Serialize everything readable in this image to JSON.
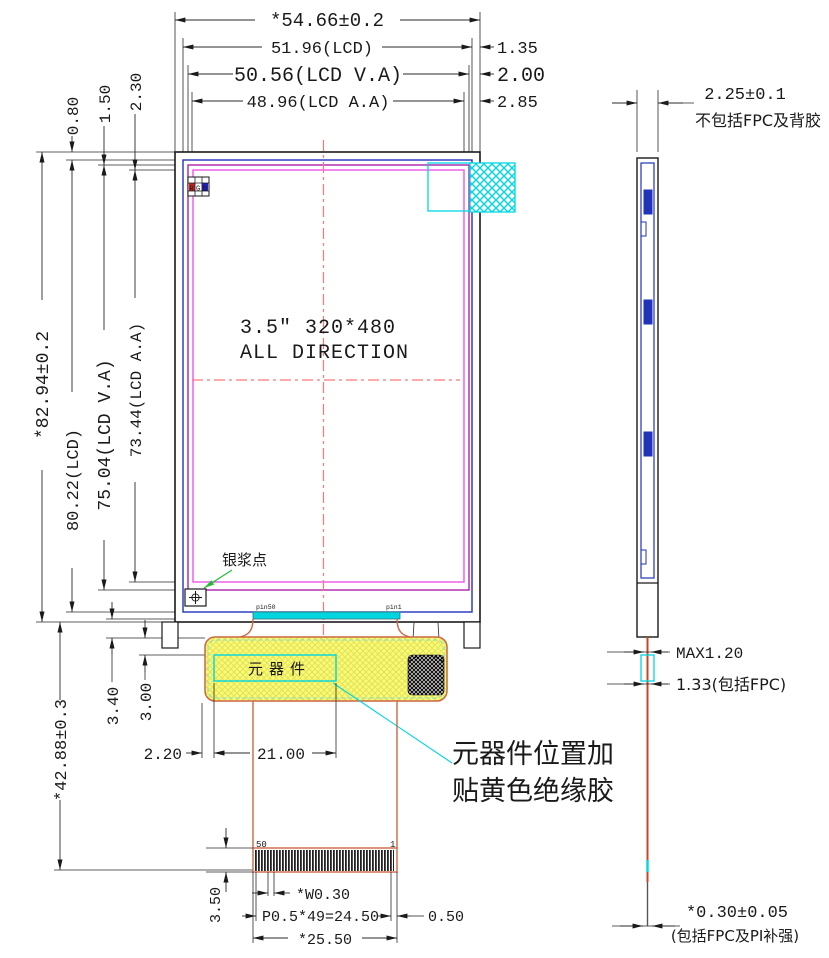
{
  "drawing_title": "3.5 inch LCD module outline drawing",
  "front_view": {
    "label_line1": "3.5\" 320*480",
    "label_line2": "ALL DIRECTION",
    "rgb": {
      "r": "R",
      "g": "G",
      "b": "B"
    },
    "silver_paste_label": "银浆点",
    "pin_label_left": "pin50",
    "pin_label_right": "pin1",
    "dims": {
      "total_width": "*54.66±0.2",
      "lcd_width": "51.96(LCD)",
      "va_width": "50.56(LCD V.A)",
      "aa_width": "48.96(LCD A.A)",
      "right_gap_lcd": "1.35",
      "right_gap_va": "2.00",
      "right_gap_aa": "2.85",
      "top_gap_lcd": "0.80",
      "top_gap_va": "1.50",
      "top_gap_aa": "2.30",
      "total_height": "*82.94±0.2",
      "lcd_height": "80.22(LCD)",
      "va_height": "75.04(LCD V.A)",
      "aa_height": "73.44(LCD A.A)"
    }
  },
  "fpc_area": {
    "component_label": "元器件",
    "note_line1": "元器件位置加",
    "note_line2": "贴黄色绝缘胶",
    "pin_number_left": "50",
    "pin_number_right": "1",
    "dims": {
      "fpc_length": "*42.88±0.3",
      "comp_offset_a": "3.00",
      "comp_offset_b": "3.40",
      "comp_left_gap": "2.20",
      "comp_width": "21.00",
      "finger_height": "3.50",
      "finger_width": "*W0.30",
      "pitch": "P0.5*49=24.50",
      "edge_gap": "0.50",
      "connector_width": "*25.50"
    }
  },
  "side_view": {
    "dims": {
      "thickness": "2.25±0.1",
      "thickness_note": "不包括FPC及背胶",
      "max_thickness": "MAX1.20",
      "fpc_zone": "1.33(包括FPC)",
      "fpc_thickness": "*0.30±0.05",
      "fpc_thickness_note": "(包括FPC及PI补强)"
    }
  },
  "colors": {
    "outline": "#1a1a1a",
    "lcd_blue": "#2233bb",
    "va_purple": "#aa22aa",
    "aa_pink": "#ee55ee",
    "centerline_red": "#ff7777",
    "cyan": "#00d5e0",
    "fpc_orange": "#cc6644",
    "yellow_fill": "#f9f97a",
    "green": "#22bb33",
    "note_red": "#e02020",
    "component_orange": "#e8a33d",
    "pin_pink": "#ff44cc"
  }
}
